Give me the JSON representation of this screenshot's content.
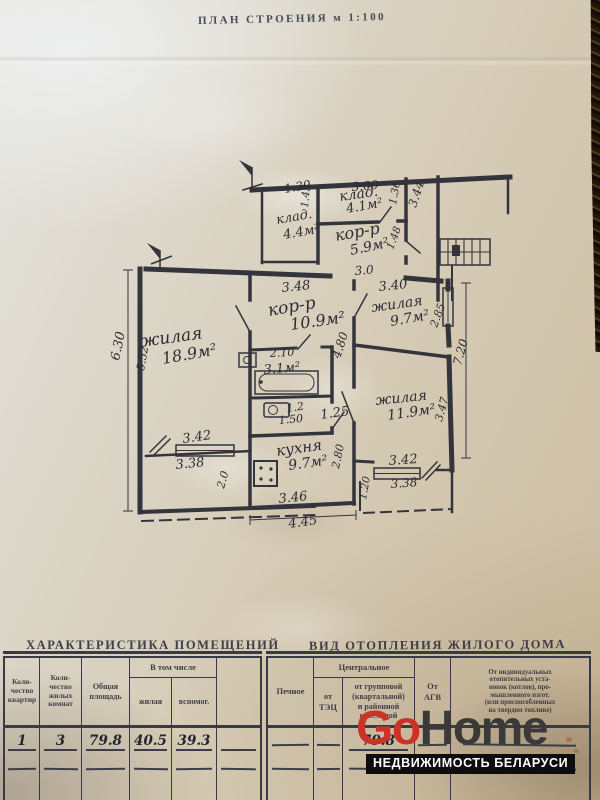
{
  "page_title": "ПЛАН СТРОЕНИЯ м 1:100",
  "plan": {
    "labels": [
      {
        "id": "dim-1-30",
        "text": "1.30",
        "x": 285,
        "y": 193,
        "r": -10,
        "s": 12
      },
      {
        "id": "dim-3-00",
        "text": "3.00",
        "x": 352,
        "y": 191,
        "r": -5,
        "s": 12
      },
      {
        "id": "room-klad-41-name",
        "text": "клад.",
        "x": 340,
        "y": 201,
        "r": -8,
        "s": 14
      },
      {
        "id": "room-klad-41-area",
        "text": "4.1м²",
        "x": 347,
        "y": 213,
        "r": -10,
        "s": 13
      },
      {
        "id": "dim-1-43",
        "text": "1.43",
        "x": 308,
        "y": 208,
        "r": -85,
        "s": 10.5
      },
      {
        "id": "dim-1-36",
        "text": "1.36",
        "x": 396,
        "y": 205,
        "r": -80,
        "s": 10.5
      },
      {
        "id": "dim-3-44",
        "text": "3.44",
        "x": 416,
        "y": 208,
        "r": -72,
        "s": 12
      },
      {
        "id": "room-klad-44-name",
        "text": "клад.",
        "x": 277,
        "y": 224,
        "r": -10,
        "s": 13
      },
      {
        "id": "room-klad-44-area",
        "text": "4.4м²",
        "x": 284,
        "y": 239,
        "r": -10,
        "s": 13
      },
      {
        "id": "room-korr-59-name",
        "text": "кор-р",
        "x": 336,
        "y": 241,
        "r": -10,
        "s": 16
      },
      {
        "id": "room-korr-59-area",
        "text": "5.9м²",
        "x": 351,
        "y": 255,
        "r": -12,
        "s": 14
      },
      {
        "id": "dim-1-48",
        "text": "1.48",
        "x": 393,
        "y": 250,
        "r": -70,
        "s": 10.5
      },
      {
        "id": "dim-3-0",
        "text": "3.0",
        "x": 355,
        "y": 275,
        "r": -5,
        "s": 12
      },
      {
        "id": "dim-3-48",
        "text": "3.48",
        "x": 282,
        "y": 292,
        "r": -6,
        "s": 13
      },
      {
        "id": "dim-3-40",
        "text": "3.40",
        "x": 379,
        "y": 291,
        "r": -6,
        "s": 13
      },
      {
        "id": "room-korr-109-name",
        "text": "кор-р",
        "x": 269,
        "y": 316,
        "r": -10,
        "s": 17
      },
      {
        "id": "room-korr-109-area",
        "text": "10.9м²",
        "x": 291,
        "y": 330,
        "r": -8,
        "s": 16
      },
      {
        "id": "room-zh-97-name",
        "text": "жилая",
        "x": 372,
        "y": 312,
        "r": -8,
        "s": 14
      },
      {
        "id": "room-zh-97-area",
        "text": "9.7м²",
        "x": 391,
        "y": 326,
        "r": -10,
        "s": 14
      },
      {
        "id": "dim-2-85",
        "text": "2.85",
        "x": 437,
        "y": 328,
        "r": -70,
        "s": 11
      },
      {
        "id": "dim-7-20",
        "text": "7.20",
        "x": 461,
        "y": 366,
        "r": -75,
        "s": 12
      },
      {
        "id": "room-zh-189-name",
        "text": "жилая",
        "x": 141,
        "y": 347,
        "r": -8,
        "s": 17
      },
      {
        "id": "room-zh-189-area",
        "text": "18.9м²",
        "x": 163,
        "y": 364,
        "r": -10,
        "s": 16
      },
      {
        "id": "dim-6-30",
        "text": "6.30",
        "x": 119,
        "y": 361,
        "r": -78,
        "s": 13
      },
      {
        "id": "dim-5-52",
        "text": "5.52",
        "x": 144,
        "y": 371,
        "r": -80,
        "s": 11
      },
      {
        "id": "dim-2-10",
        "text": "2.10",
        "x": 270,
        "y": 357,
        "r": -3,
        "s": 11
      },
      {
        "id": "room-bath-area",
        "text": "3.1м²",
        "x": 264,
        "y": 374,
        "r": -5,
        "s": 13
      },
      {
        "id": "dim-4-80",
        "text": "4.80",
        "x": 340,
        "y": 359,
        "r": -72,
        "s": 12
      },
      {
        "id": "room-wc-area",
        "text": "1.2",
        "x": 287,
        "y": 412,
        "r": -8,
        "s": 11
      },
      {
        "id": "dim-1-50",
        "text": "1.50",
        "x": 279,
        "y": 424,
        "r": -5,
        "s": 11
      },
      {
        "id": "dim-1-25",
        "text": "1.25",
        "x": 321,
        "y": 419,
        "r": -8,
        "s": 13
      },
      {
        "id": "room-zh-119-name",
        "text": "жилая",
        "x": 376,
        "y": 405,
        "r": -6,
        "s": 14
      },
      {
        "id": "room-zh-119-area",
        "text": "11.9м²",
        "x": 388,
        "y": 420,
        "r": -8,
        "s": 14
      },
      {
        "id": "dim-3-47",
        "text": "3.47",
        "x": 442,
        "y": 422,
        "r": -75,
        "s": 11
      },
      {
        "id": "dim-3-42-left",
        "text": "3.42",
        "x": 183,
        "y": 443,
        "r": -8,
        "s": 13
      },
      {
        "id": "dim-3-38-left",
        "text": "3.38",
        "x": 176,
        "y": 469,
        "r": -6,
        "s": 13
      },
      {
        "id": "dim-2-0",
        "text": "2.0",
        "x": 224,
        "y": 489,
        "r": -75,
        "s": 11
      },
      {
        "id": "room-kitchen-name",
        "text": "кухня",
        "x": 277,
        "y": 456,
        "r": -8,
        "s": 15
      },
      {
        "id": "room-kitchen-area",
        "text": "9.7м²",
        "x": 289,
        "y": 470,
        "r": -8,
        "s": 14
      },
      {
        "id": "dim-2-80",
        "text": "2.80",
        "x": 339,
        "y": 469,
        "r": -78,
        "s": 11
      },
      {
        "id": "dim-3-42-right",
        "text": "3.42",
        "x": 389,
        "y": 465,
        "r": -4,
        "s": 13
      },
      {
        "id": "dim-3-38-right",
        "text": "3.38",
        "x": 391,
        "y": 488,
        "r": -4,
        "s": 12
      },
      {
        "id": "dim-1-20",
        "text": "1.20",
        "x": 366,
        "y": 500,
        "r": -80,
        "s": 10.5
      },
      {
        "id": "dim-3-46",
        "text": "3.46",
        "x": 279,
        "y": 503,
        "r": -6,
        "s": 13
      },
      {
        "id": "dim-4-45",
        "text": "4.45",
        "x": 289,
        "y": 528,
        "r": -8,
        "s": 13
      }
    ]
  },
  "tables": {
    "left": {
      "title": "ХАРАКТЕРИСТИКА ПОМЕЩЕНИЙ",
      "headers": {
        "apartments": "Коли-\nчество\nквартир",
        "rooms": "Коли-\nчество\nжилых\nкомнат",
        "total_area": "Общая\nплощадь",
        "including": "В том числе",
        "living": "жилая",
        "auxiliary": "вспомог."
      },
      "values": {
        "apartments": "1",
        "rooms": "3",
        "total_area": "79.8",
        "living": "40.5",
        "auxiliary": "39.3"
      }
    },
    "right": {
      "title": "ВИД ОТОПЛЕНИЯ ЖИЛОГО ДОМА",
      "headers": {
        "stove": "Печное",
        "central": "Центральное",
        "from_tec": "от\nТЭЦ",
        "from_group": "от групповой\n(квартальной)\nи районной\nкотельной",
        "from_agv": "От\nАГВ",
        "individual": "От индивидуальных\nотопительных уста-\nновок (котлов), про-\nмышленного изгот.\n(или приспособленных\nна твердом топливе)"
      },
      "values": {
        "from_group": "79.8"
      }
    }
  },
  "logo": {
    "go": "Go",
    "home": "Home",
    "tagline": "НЕДВИЖИМОСТЬ БЕЛАРУСИ"
  }
}
